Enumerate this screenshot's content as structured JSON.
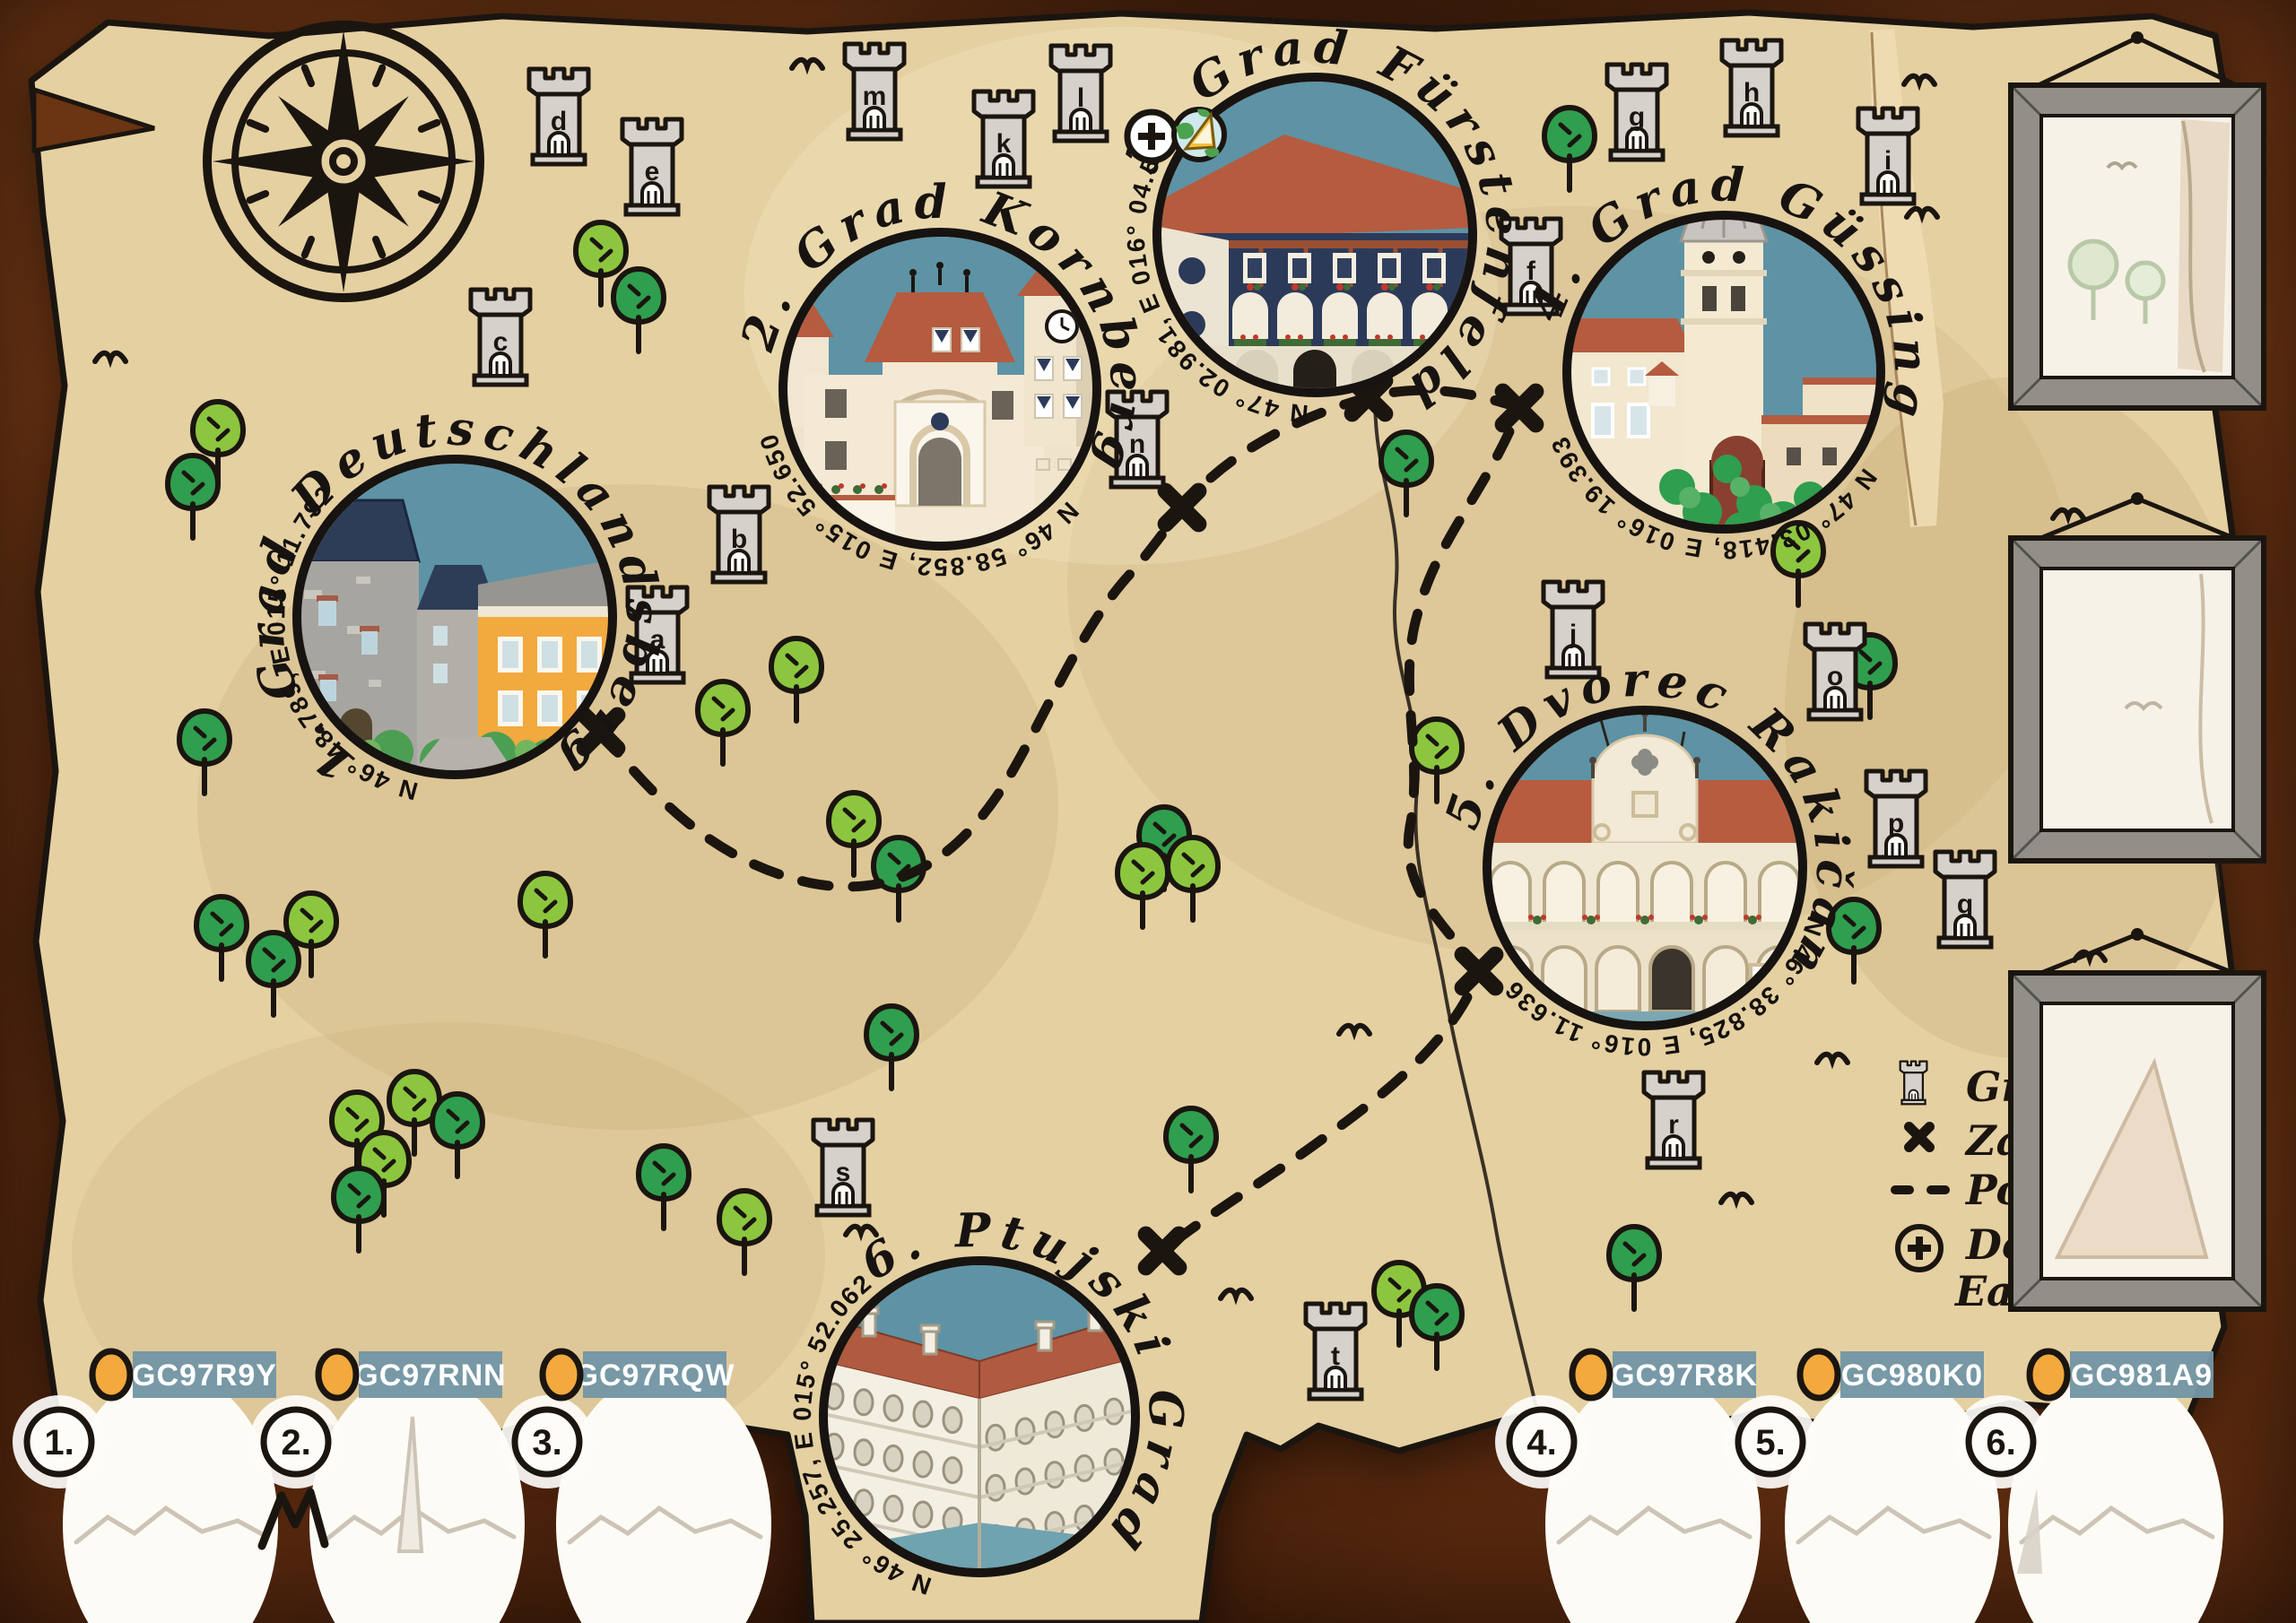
{
  "poster": {
    "castles": [
      {
        "number": "1.",
        "title": "1. Grad Deutschlandsberg",
        "coordinates": "N 46° 48.789, E 015° 11.792",
        "gc_code": "GC97R9Y"
      },
      {
        "number": "2.",
        "title": "2. Grad Kornberg",
        "coordinates": "N 46° 58.852, E 015° 52.650",
        "gc_code": "GC97RNN"
      },
      {
        "number": "3.",
        "title": "3. Grad Fürstenfeld",
        "coordinates": "N 47° 02.981, E 016° 04.540",
        "gc_code": "GC97RQW"
      },
      {
        "number": "4.",
        "title": "4. Grad Güssing",
        "coordinates": "N 47° 03.418, E 016° 19.393",
        "gc_code": "GC97R8K"
      },
      {
        "number": "5.",
        "title": "5. Dvorec Rakičan",
        "coordinates": "N 46° 38.825, E 016° 11.636",
        "gc_code": "GC980K0"
      },
      {
        "number": "6.",
        "title": "6. Ptujski Grad",
        "coordinates": "N 46° 25.257, E 015° 52.062",
        "gc_code": "GC981A9"
      }
    ],
    "tower_letters": [
      "a",
      "b",
      "c",
      "d",
      "e",
      "f",
      "g",
      "h",
      "i",
      "j",
      "k",
      "l",
      "m",
      "n",
      "o",
      "p",
      "q",
      "r",
      "s",
      "t"
    ],
    "legend": {
      "items": [
        {
          "icon": "tower-icon",
          "label": "Grad"
        },
        {
          "icon": "x-icon",
          "label": "Zaklad"
        },
        {
          "icon": "dash-icon",
          "label": "Pot"
        },
        {
          "icon": "plus-icon",
          "label": "Dodatni EarthCache",
          "line1": "Dodatni",
          "line2": "EarthCache"
        }
      ]
    },
    "colors": {
      "parchment": "#e5d0a1",
      "leather": "#5a2b10",
      "sky": "#5d93a5",
      "roof_red": "#b55b3f",
      "navy": "#2c3a5a",
      "tree_light": "#8cc63e",
      "tree_dark": "#2f9e4e",
      "gc_label_bg": "#7396a4",
      "gc_dot": "#f3a93d",
      "tower_fill": "#d6d2cb",
      "ink": "#1b1510"
    }
  }
}
